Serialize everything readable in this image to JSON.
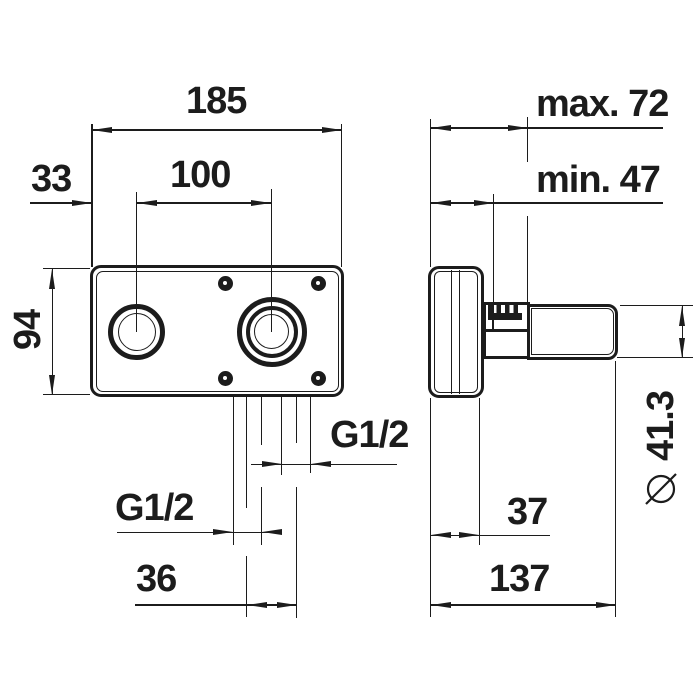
{
  "colors": {
    "line": "#1c1c1c",
    "background": "#ffffff"
  },
  "front_view": {
    "dim_total_width": "185",
    "dim_left_valve_offset": "33",
    "dim_valve_spacing": "100",
    "dim_total_height": "94",
    "dim_right_outlet_thread": "G1/2",
    "dim_left_outlet_thread": "G1/2",
    "dim_outlet_spacing": "36"
  },
  "side_view": {
    "dim_wall_depth_max": "max. 72",
    "dim_wall_depth_min": "min. 47",
    "diameter_symbol": "⌀",
    "dim_spout_diameter_value": "41.3",
    "dim_body_depth": "37",
    "dim_total_depth": "137"
  }
}
